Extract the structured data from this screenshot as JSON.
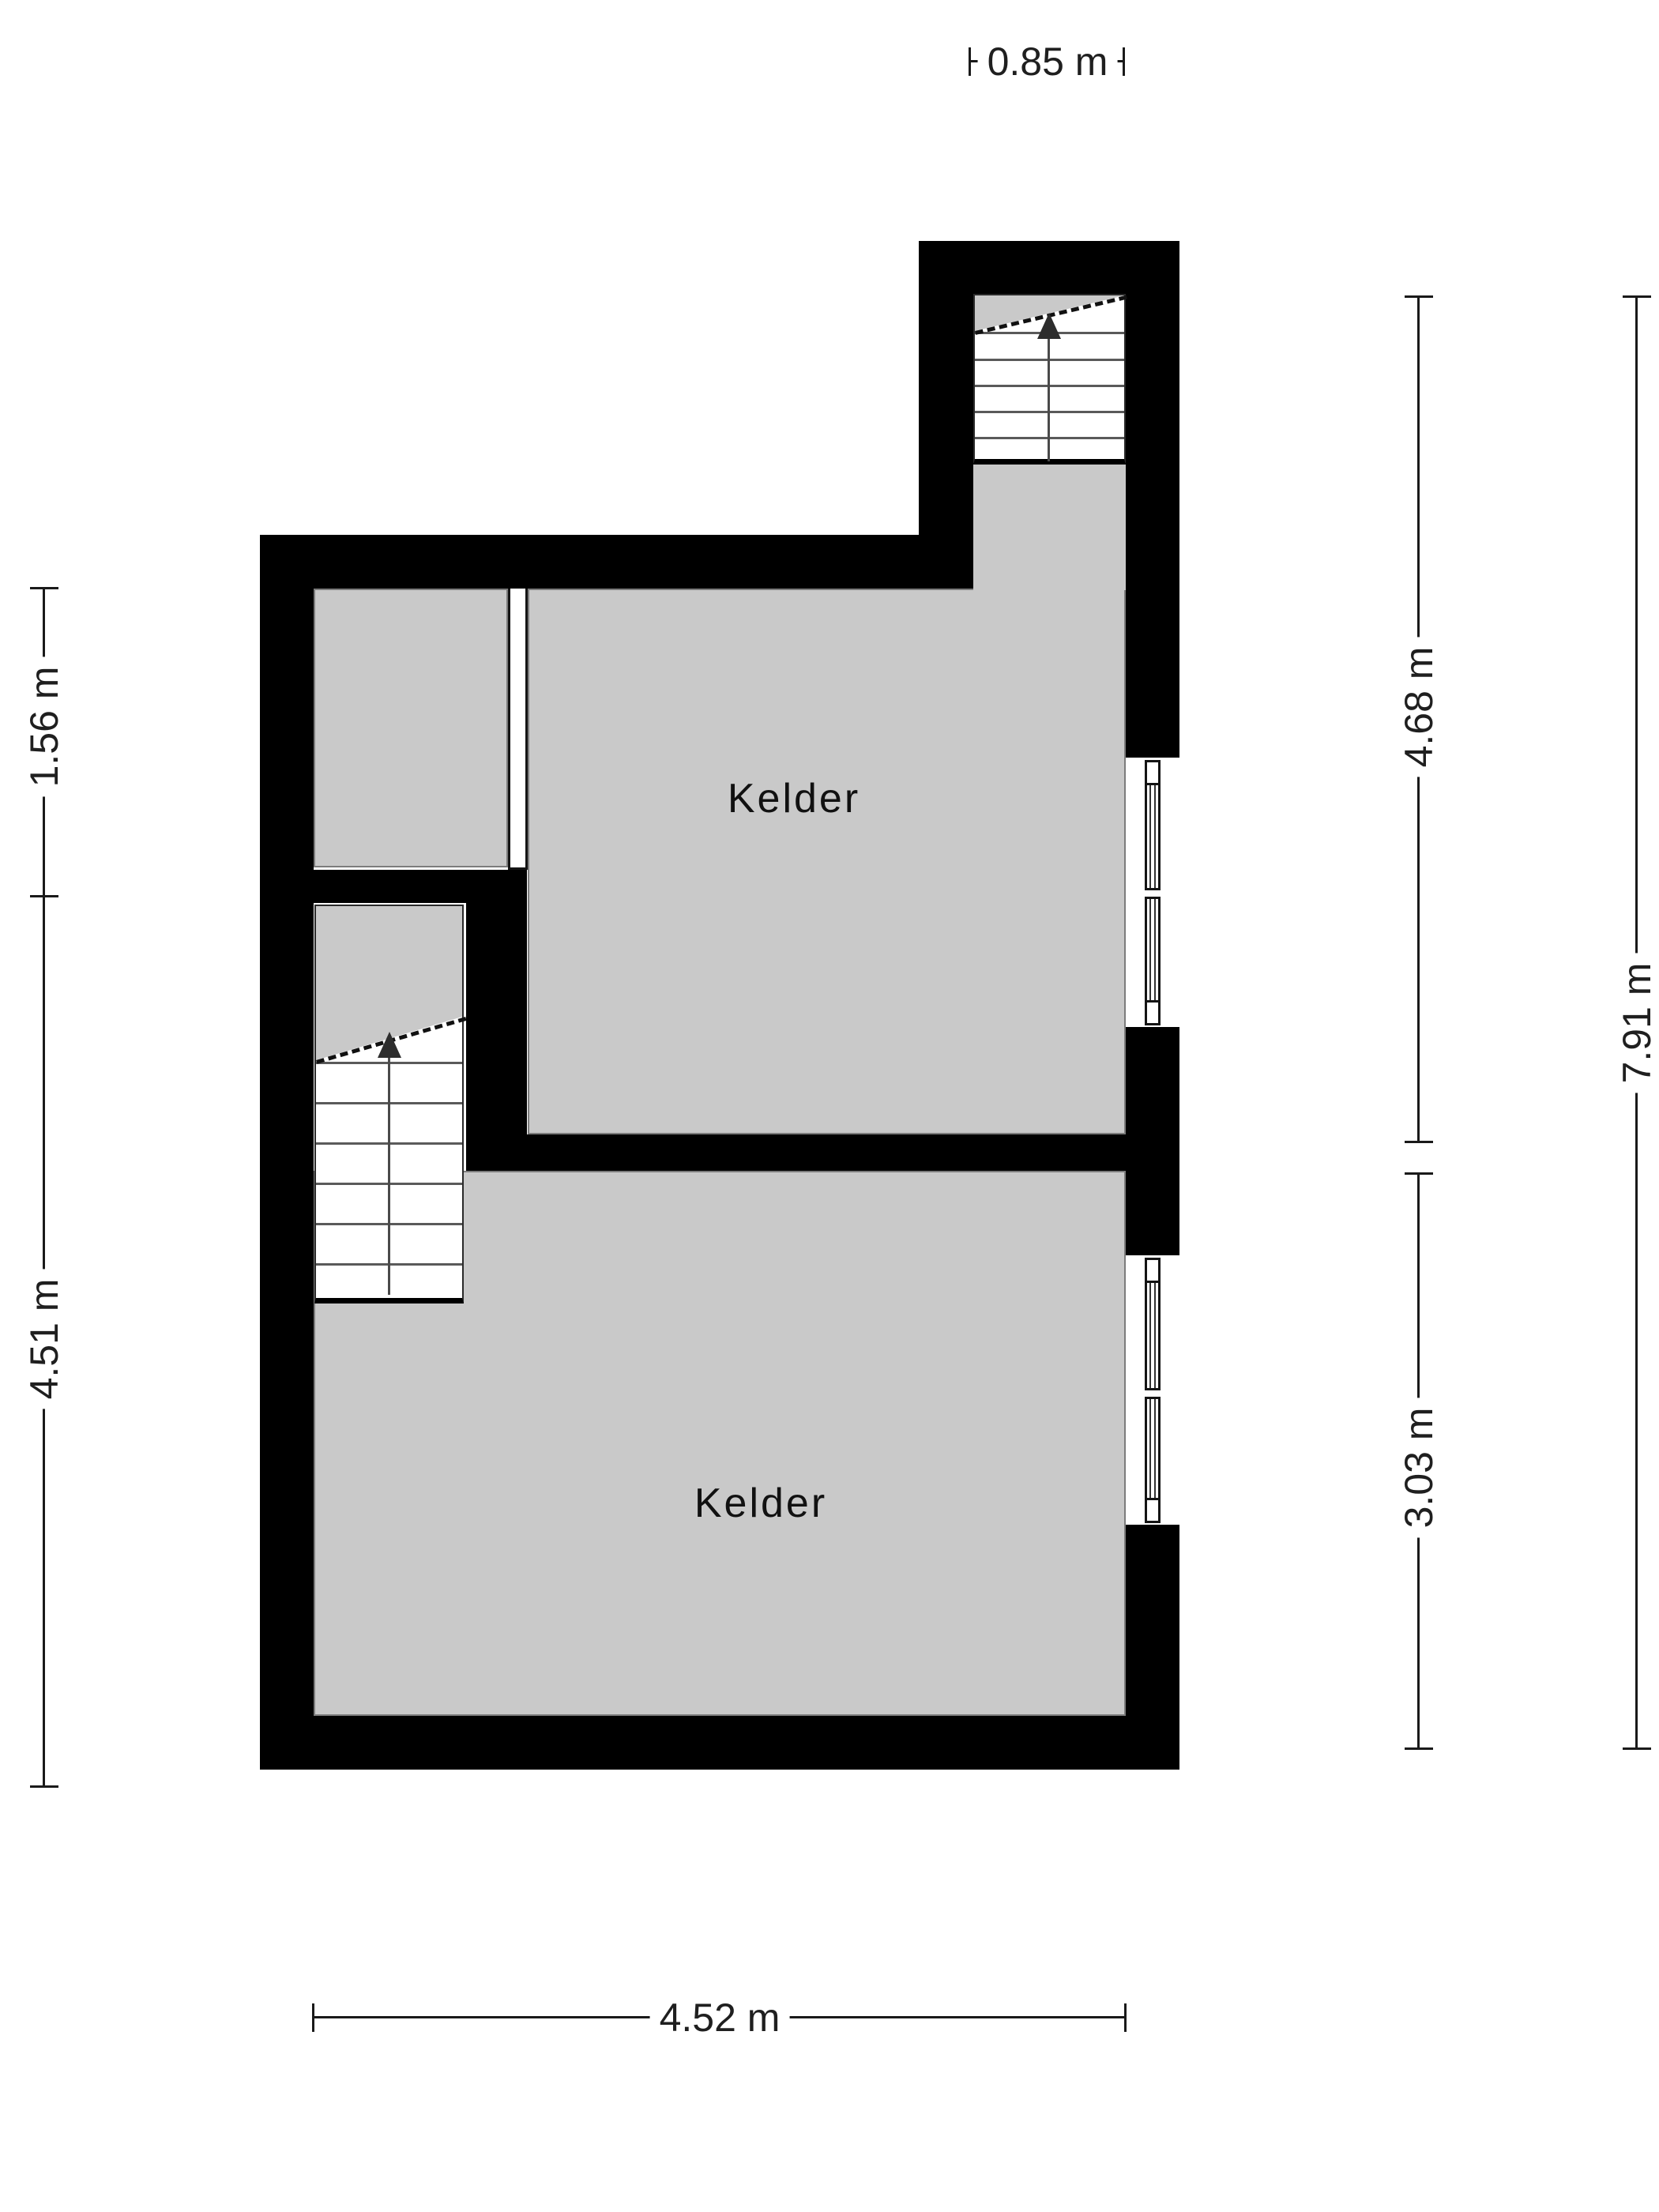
{
  "title": "Basement floor plan",
  "rooms": [
    {
      "label": "Kelder"
    },
    {
      "label": "Kelder"
    }
  ],
  "stairs": [
    {
      "name": "upper-staircase",
      "direction": "up"
    },
    {
      "name": "lower-staircase",
      "direction": "up"
    }
  ],
  "dimensions": {
    "top": "0.85 m",
    "left_upper": "1.56 m",
    "left_lower": "4.51 m",
    "right_upper": "4.68 m",
    "right_lower": "3.03 m",
    "right_total": "7.91 m",
    "bottom": "4.52 m"
  },
  "colors": {
    "wall": "#000000",
    "floor": "#c9c9c9",
    "dimension_line": "#1a1a1a",
    "background": "#ffffff"
  }
}
